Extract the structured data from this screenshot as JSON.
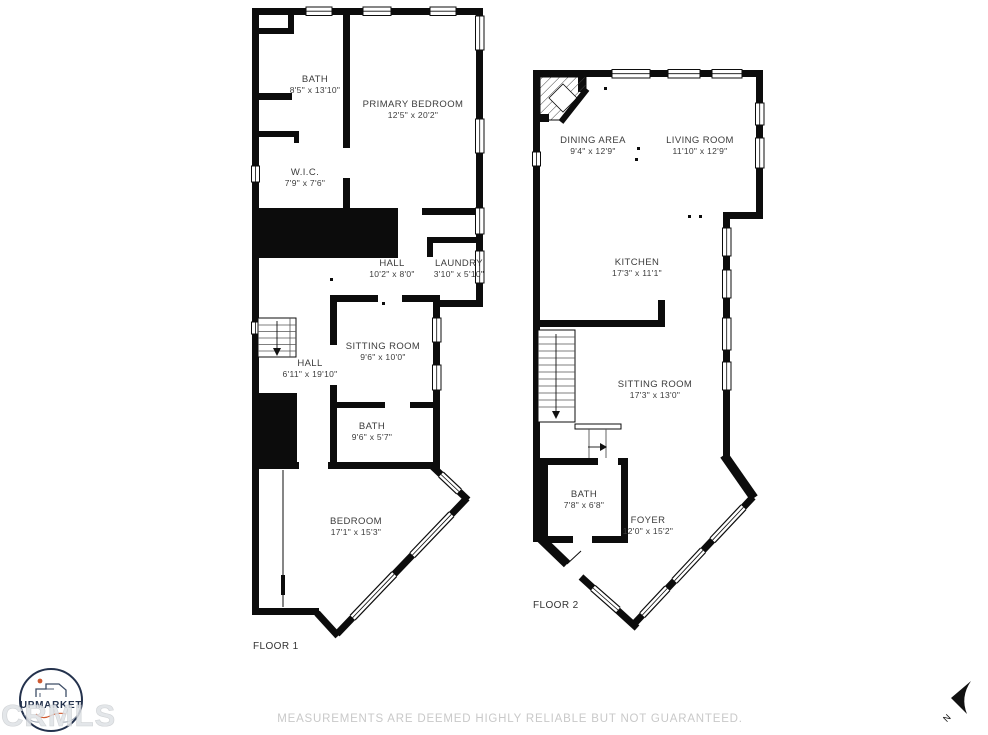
{
  "floors": [
    {
      "label": "FLOOR 1",
      "rooms": [
        {
          "name": "BATH",
          "dims": "8'5\" x 13'10\""
        },
        {
          "name": "PRIMARY BEDROOM",
          "dims": "12'5\" x 20'2\""
        },
        {
          "name": "W.I.C.",
          "dims": "7'9\" x 7'6\""
        },
        {
          "name": "HALL",
          "dims": "10'2\" x 8'0\""
        },
        {
          "name": "LAUNDRY",
          "dims": "3'10\" x 5'10\""
        },
        {
          "name": "SITTING ROOM",
          "dims": "9'6\" x 10'0\""
        },
        {
          "name": "HALL",
          "dims": "6'11\" x 19'10\""
        },
        {
          "name": "BATH",
          "dims": "9'6\" x 5'7\""
        },
        {
          "name": "BEDROOM",
          "dims": "17'1\" x 15'3\""
        }
      ]
    },
    {
      "label": "FLOOR 2",
      "rooms": [
        {
          "name": "DINING AREA",
          "dims": "9'4\" x 12'9\""
        },
        {
          "name": "LIVING ROOM",
          "dims": "11'10\" x 12'9\""
        },
        {
          "name": "KITCHEN",
          "dims": "17'3\" x 11'1\""
        },
        {
          "name": "SITTING ROOM",
          "dims": "17'3\" x 13'0\""
        },
        {
          "name": "BATH",
          "dims": "7'8\" x 6'8\""
        },
        {
          "name": "FOYER",
          "dims": "12'0\" x 15'2\""
        }
      ]
    }
  ],
  "footer": {
    "disclaimer": "MEASUREMENTS ARE DEEMED HIGHLY RELIABLE BUT NOT GUARANTEED."
  },
  "logo": {
    "brand": "UPMARKET"
  },
  "watermark": "CRMLS",
  "compass": {
    "label": "N"
  },
  "colors": {
    "wall": "#0c0c0c",
    "label": "#3c3c3c",
    "disclaimer": "#c9c9c9",
    "watermark": "#dfe2e6",
    "watermark_stroke": "#c8cbce",
    "logo_navy": "#24324d",
    "logo_accent": "#cf5a31"
  }
}
